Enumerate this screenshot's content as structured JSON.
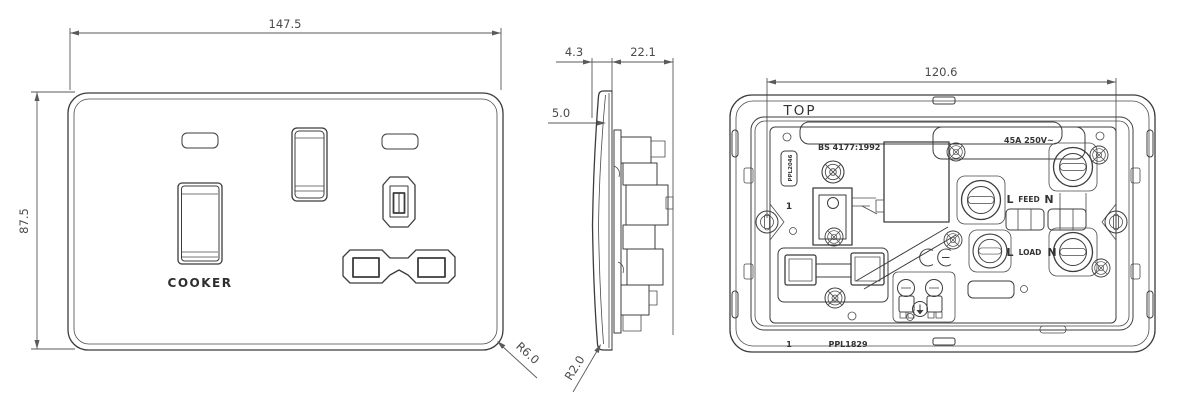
{
  "colors": {
    "line": "#3c3c3c",
    "dim_line": "#5a5a5a",
    "background": "#ffffff"
  },
  "front_view": {
    "width_dim": "147.5",
    "height_dim": "87.5",
    "switch_label": "COOKER",
    "corner_radius_label": "R6.0"
  },
  "side_view": {
    "plate_thickness_dim": "4.3",
    "depth_dim": "22.1",
    "edge_dim": "5.0",
    "corner_radius_label": "R2.0"
  },
  "back_view": {
    "fixing_centres_dim": "120.6",
    "orientation_label": "TOP",
    "standard_text": "BS 4177:1992",
    "rating_text": "45A 250V~",
    "moulding_code_vertical": "PPL2046",
    "gang_marker": "1",
    "feed_terminals": {
      "live": "L",
      "label": "FEED",
      "neutral": "N"
    },
    "load_terminals": {
      "live": "L",
      "label": "LOAD",
      "neutral": "N"
    },
    "ce_mark_icon": "CE",
    "bottom_gang_marker": "1",
    "part_number": "PPL1829"
  }
}
